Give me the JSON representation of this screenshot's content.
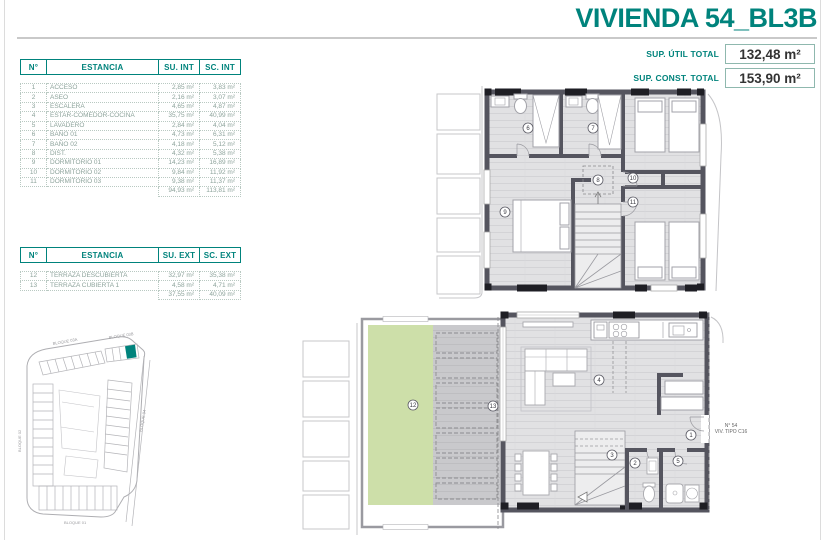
{
  "header": {
    "title": "VIVIENDA 54_BL3B",
    "totals": [
      {
        "label": "SUP. ÚTIL TOTAL",
        "value": "132,48 m²"
      },
      {
        "label": "SUP. CONST. TOTAL",
        "value": "153,90 m²"
      }
    ]
  },
  "tables": {
    "interior": {
      "headers": {
        "num": "N°",
        "name": "ESTANCIA",
        "su": "SU. INT",
        "sc": "SC. INT"
      },
      "rows": [
        {
          "num": "1",
          "name": "ACCESO",
          "su": "2,85 m²",
          "sc": "3,83 m²"
        },
        {
          "num": "2",
          "name": "ASEO",
          "su": "2,16 m²",
          "sc": "3,07 m²"
        },
        {
          "num": "3",
          "name": "ESCALERA",
          "su": "4,65 m²",
          "sc": "4,87 m²"
        },
        {
          "num": "4",
          "name": "ESTAR-COMEDOR-COCINA",
          "su": "35,75 m²",
          "sc": "40,99 m²"
        },
        {
          "num": "5",
          "name": "LAVADERO",
          "su": "2,84 m²",
          "sc": "4,04 m²"
        },
        {
          "num": "6",
          "name": "BAÑO 01",
          "su": "4,73 m²",
          "sc": "6,31 m²"
        },
        {
          "num": "7",
          "name": "BAÑO 02",
          "su": "4,18 m²",
          "sc": "5,12 m²"
        },
        {
          "num": "8",
          "name": "DIST.",
          "su": "4,32 m²",
          "sc": "5,38 m²"
        },
        {
          "num": "9",
          "name": "DORMITORIO 01",
          "su": "14,23 m²",
          "sc": "16,89 m²"
        },
        {
          "num": "10",
          "name": "DORMITORIO 02",
          "su": "9,84 m²",
          "sc": "11,92 m²"
        },
        {
          "num": "11",
          "name": "DORMITORIO 03",
          "su": "9,38 m²",
          "sc": "11,37 m²"
        }
      ],
      "total": {
        "su": "94,93 m²",
        "sc": "113,81 m²"
      }
    },
    "exterior": {
      "headers": {
        "num": "N°",
        "name": "ESTANCIA",
        "su": "SU. EXT",
        "sc": "SC. EXT"
      },
      "rows": [
        {
          "num": "12",
          "name": "TERRAZA DESCUBIERTA",
          "su": "32,97 m²",
          "sc": "35,38 m²"
        },
        {
          "num": "13",
          "name": "TERRAZA CUBIERTA 1",
          "su": "4,58 m²",
          "sc": "4,71 m²"
        }
      ],
      "total": {
        "su": "37,55 m²",
        "sc": "40,09 m²"
      }
    }
  },
  "site_plan": {
    "labels": {
      "b03a": "BLOQUE 03A",
      "b03b": "BLOQUE 03B",
      "b02": "BLOQUE 02",
      "b04": "BLOQUE 04",
      "b01": "BLOQUE 01"
    }
  },
  "upper_plan": {
    "rooms": {
      "bano01": "6",
      "bano02": "7",
      "dist": "8",
      "dorm01": "9",
      "dorm02": "10",
      "dorm03": "11"
    }
  },
  "lower_plan": {
    "rooms": {
      "acceso": "1",
      "aseo": "2",
      "escalera": "3",
      "estar": "4",
      "lavadero": "5",
      "terraza12": "12",
      "terraza13": "13"
    },
    "annotation": {
      "line1": "N° 54",
      "line2": "VIV. TIPO C16"
    }
  },
  "colors": {
    "accent": "#00837C",
    "wall": "#55555F",
    "terrace_green": "#CDDFA9"
  }
}
